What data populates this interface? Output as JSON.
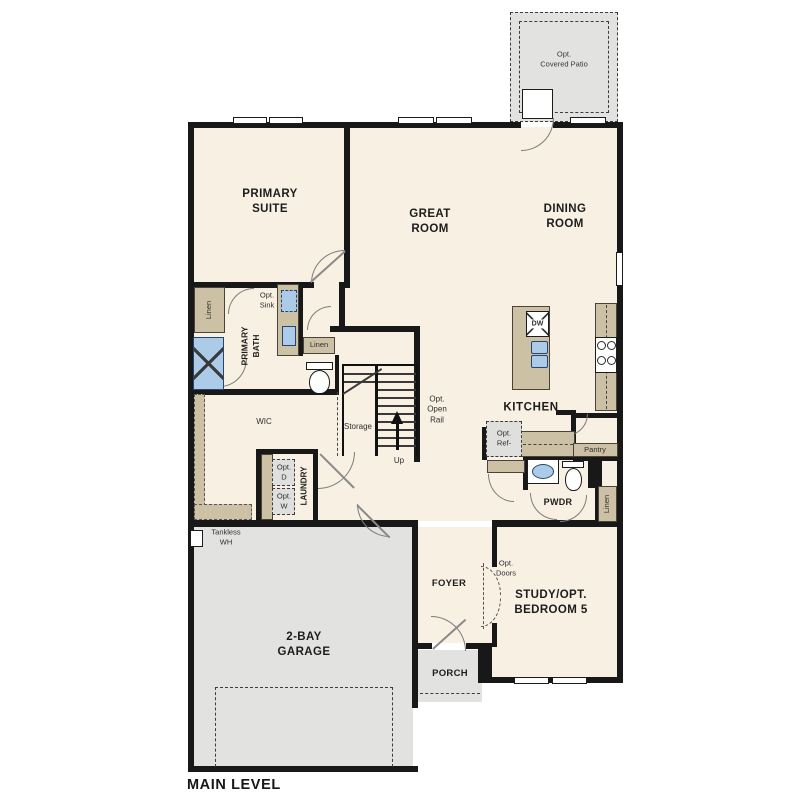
{
  "plan": {
    "title": "MAIN LEVEL",
    "rooms": {
      "primary_suite": "PRIMARY\nSUITE",
      "great_room": "GREAT\nROOM",
      "dining_room": "DINING\nROOM",
      "kitchen": "KITCHEN",
      "primary_bath": "PRIMARY\nBATH",
      "wic": "WIC",
      "laundry": "LAUNDRY",
      "pwdr": "PWDR",
      "foyer": "FOYER",
      "porch": "PORCH",
      "study": "STUDY/OPT.\nBEDROOM 5",
      "garage": "2-BAY\nGARAGE",
      "storage": "Storage"
    },
    "features": {
      "covered_patio": "Opt.\nCovered Patio",
      "opt_sink": "Opt.\nSink",
      "linen_closet_bath": "Linen",
      "linen_cabinet_bath": "Linen",
      "linen_closet_hall": "Linen",
      "opt_open_rail": "Opt.\nOpen\nRail",
      "up": "Up",
      "opt_dryer": "Opt.\nD",
      "opt_washer": "Opt.\nW",
      "tankless_wh": "Tankless\nWH",
      "opt_ref": "Opt.\nRef-",
      "pantry": "Pantry",
      "opt_doors": "Opt.\nDoors",
      "dishwasher": "DW"
    },
    "colors": {
      "wall": "#181818",
      "floor": "#f8f0e2",
      "concrete": "#e2e2e0",
      "cabinet": "#cdc1a5",
      "fixture_blue": "#abcbe9"
    }
  }
}
